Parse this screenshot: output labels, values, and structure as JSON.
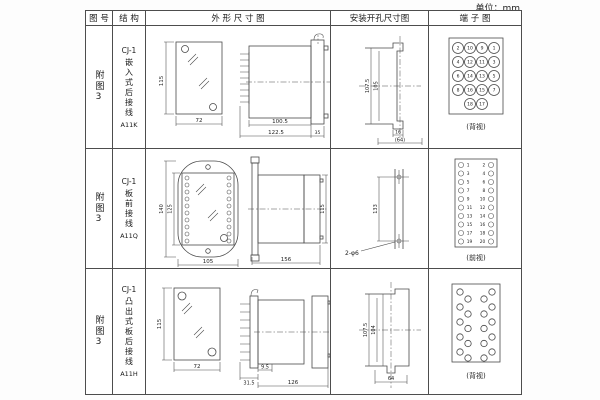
{
  "page": {
    "unit_label": "单位：mm"
  },
  "table": {
    "headers": [
      "图 号",
      "结 构",
      "外 形 尺 寸 图",
      "安装开孔尺寸图",
      "端 子 图"
    ]
  },
  "rows": [
    {
      "fig": "附图3",
      "series": "CJ-1",
      "structure": "嵌入式后接线",
      "model": "A11K",
      "outline": {
        "front_h": "115",
        "front_w": "72",
        "body_w": "100.5",
        "total_w": "122.5",
        "flange_w": "35"
      },
      "install": {
        "outer_h": "107.5",
        "inner_h": "105",
        "slot_w": "16",
        "span_w": "(64)"
      },
      "terminal": {
        "caption": "(背视)"
      }
    },
    {
      "fig": "附图3",
      "series": "CJ-1",
      "structure": "板前接线",
      "model": "A11Q",
      "outline": {
        "front_h_outer": "140",
        "front_h_inner": "125",
        "front_w": "105",
        "side_len": "156",
        "side_h": "115"
      },
      "install": {
        "hole_span": "133",
        "hole_label": "2-φ6"
      },
      "terminal": {
        "caption": "(前视)"
      }
    },
    {
      "fig": "附图3",
      "series": "CJ-1",
      "structure": "凸出式板后接线",
      "model": "A11H",
      "outline": {
        "front_h": "115",
        "front_w": "72",
        "comb_w": "31.5",
        "gap_w": "9.5",
        "body_w": "126"
      },
      "install": {
        "outer_h": "107.5",
        "inner_h": "104",
        "span_w": "64"
      },
      "terminal": {
        "caption": "(背视)"
      }
    }
  ],
  "t1": {
    "grid": [
      [
        "2",
        "10",
        "9",
        "1"
      ],
      [
        "4",
        "12",
        "11",
        "3"
      ],
      [
        "6",
        "14",
        "13",
        "5"
      ],
      [
        "8",
        "16",
        "15",
        "7"
      ],
      [
        "18",
        "17"
      ]
    ]
  },
  "t2": {
    "left": [
      "1",
      "3",
      "5",
      "7",
      "9",
      "11",
      "13",
      "15",
      "17",
      "19"
    ],
    "right": [
      "2",
      "4",
      "6",
      "8",
      "10",
      "12",
      "14",
      "16",
      "18",
      "20"
    ]
  }
}
